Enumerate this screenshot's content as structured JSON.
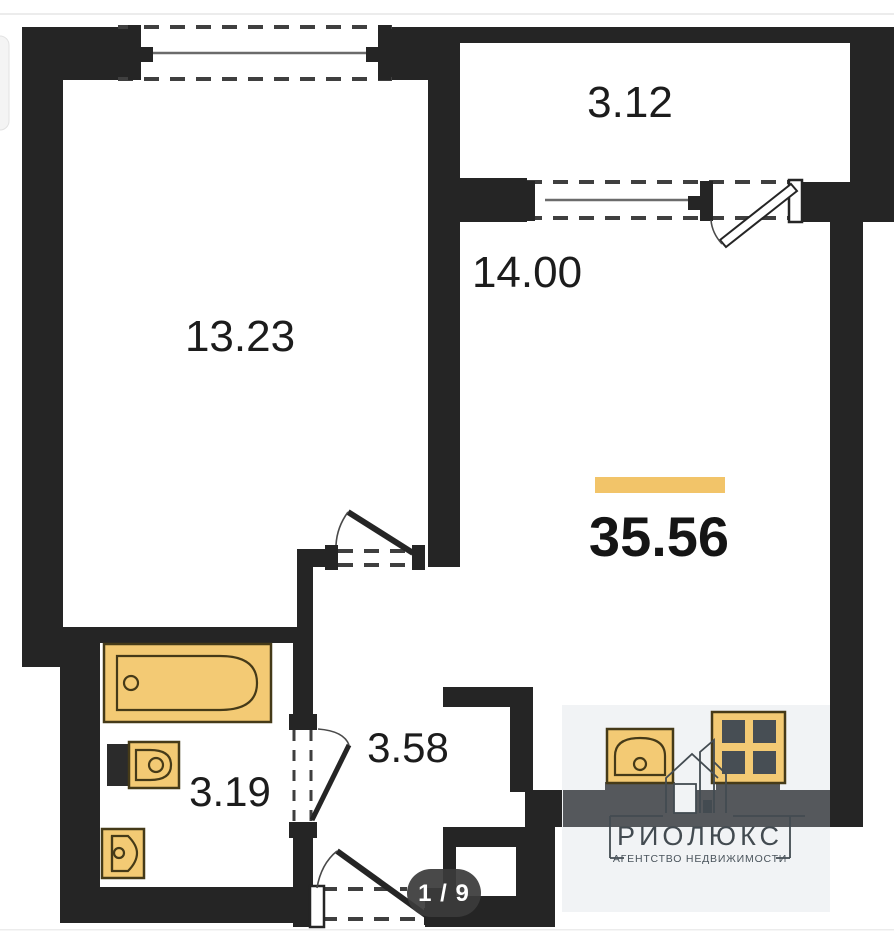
{
  "viewer": {
    "page_indicator": "1 / 9"
  },
  "floorplan": {
    "total_area": "35.56",
    "rooms": [
      {
        "name": "balcony",
        "area": "3.12"
      },
      {
        "name": "main-room",
        "area": "14.00"
      },
      {
        "name": "left-room",
        "area": "13.23"
      },
      {
        "name": "bathroom",
        "area": "3.19"
      },
      {
        "name": "hallway",
        "area": "3.58"
      }
    ],
    "fixtures": [
      "bathtub",
      "washbasin",
      "toilet",
      "kitchen-sink",
      "stove"
    ],
    "colors": {
      "wall": "#252525",
      "fixture_fill": "#f3ca74",
      "fixture_stroke": "#453a18",
      "accent_bar": "#f2c469",
      "counter": "#55585c",
      "watermark_bg": "#f1f3f5",
      "logo": "#434b51",
      "badge_bg": "#3b3b3b"
    }
  },
  "watermark": {
    "brand": "РИОЛЮКС",
    "tagline": "АГЕНТСТВО НЕДВИЖИМОСТИ"
  }
}
